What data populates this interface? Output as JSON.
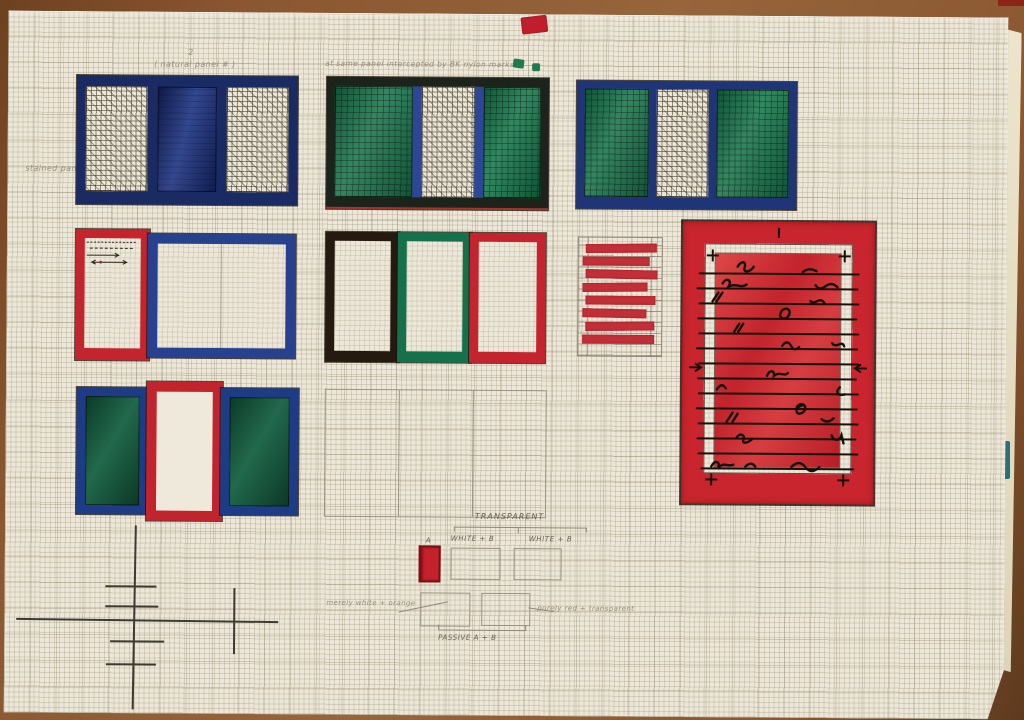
{
  "meta": {
    "type": "photograph of hand-drawn design sketch",
    "medium": "marker and pencil on graph paper",
    "subject": "stained-glass / window panel colour studies"
  },
  "annotations": {
    "panel1_number": "2",
    "panel1_caption": "( natural  panel  # )",
    "panel2_caption": "at same panel intercepted by BK nylon marks",
    "left_margin_label": "stained  panel",
    "transparent_label": "TRANSPARENT",
    "white_b_left": "WHITE + B",
    "white_b_right": "WHITE + B",
    "swatch_letter": "A",
    "passive_label": "PASSIVE   A + B",
    "note_left": "merely white + orange",
    "note_right": "purely red + transparent"
  },
  "palette": {
    "paper": "#ece7d8",
    "table_brown": "#8a5730",
    "marker_red": "#c3242e",
    "marker_blue": "#27418f",
    "marker_navy": "#1a2a63",
    "marker_green": "#1b7a4f",
    "marker_dark_brown": "#241a10",
    "pencil_gray": "#8f8879",
    "teal_mark": "#2b6f7a"
  },
  "striped_panel": {
    "bands": 8,
    "band_widths_pct": [
      96,
      90,
      97,
      88,
      95,
      86,
      93,
      97
    ],
    "color": "#c22f38"
  },
  "panels": [
    {
      "id": "row1-panel1",
      "desc": "navy frame, hatched white / solid navy / hatched white panes"
    },
    {
      "id": "row1-panel2",
      "desc": "dark frame, green / blue-edged hatched white / green panes"
    },
    {
      "id": "row1-panel3",
      "desc": "navy frame, green / hatched white / green panes"
    },
    {
      "id": "row2-panel4",
      "desc": "red portrait frame with wire sketch + wide blue frame, empty"
    },
    {
      "id": "row2-panel5",
      "desc": "three empty frames: dark brown, green, red"
    },
    {
      "id": "row2-striped",
      "desc": "pencil grid with eight rough red bands"
    },
    {
      "id": "row2-big-red",
      "desc": "large red frame, red field with black wire scribble lines"
    },
    {
      "id": "row3-panel6",
      "desc": "blue/green, red/white, blue/green panes"
    },
    {
      "id": "row3-empty",
      "desc": "empty pencil rectangle divided in three"
    }
  ]
}
